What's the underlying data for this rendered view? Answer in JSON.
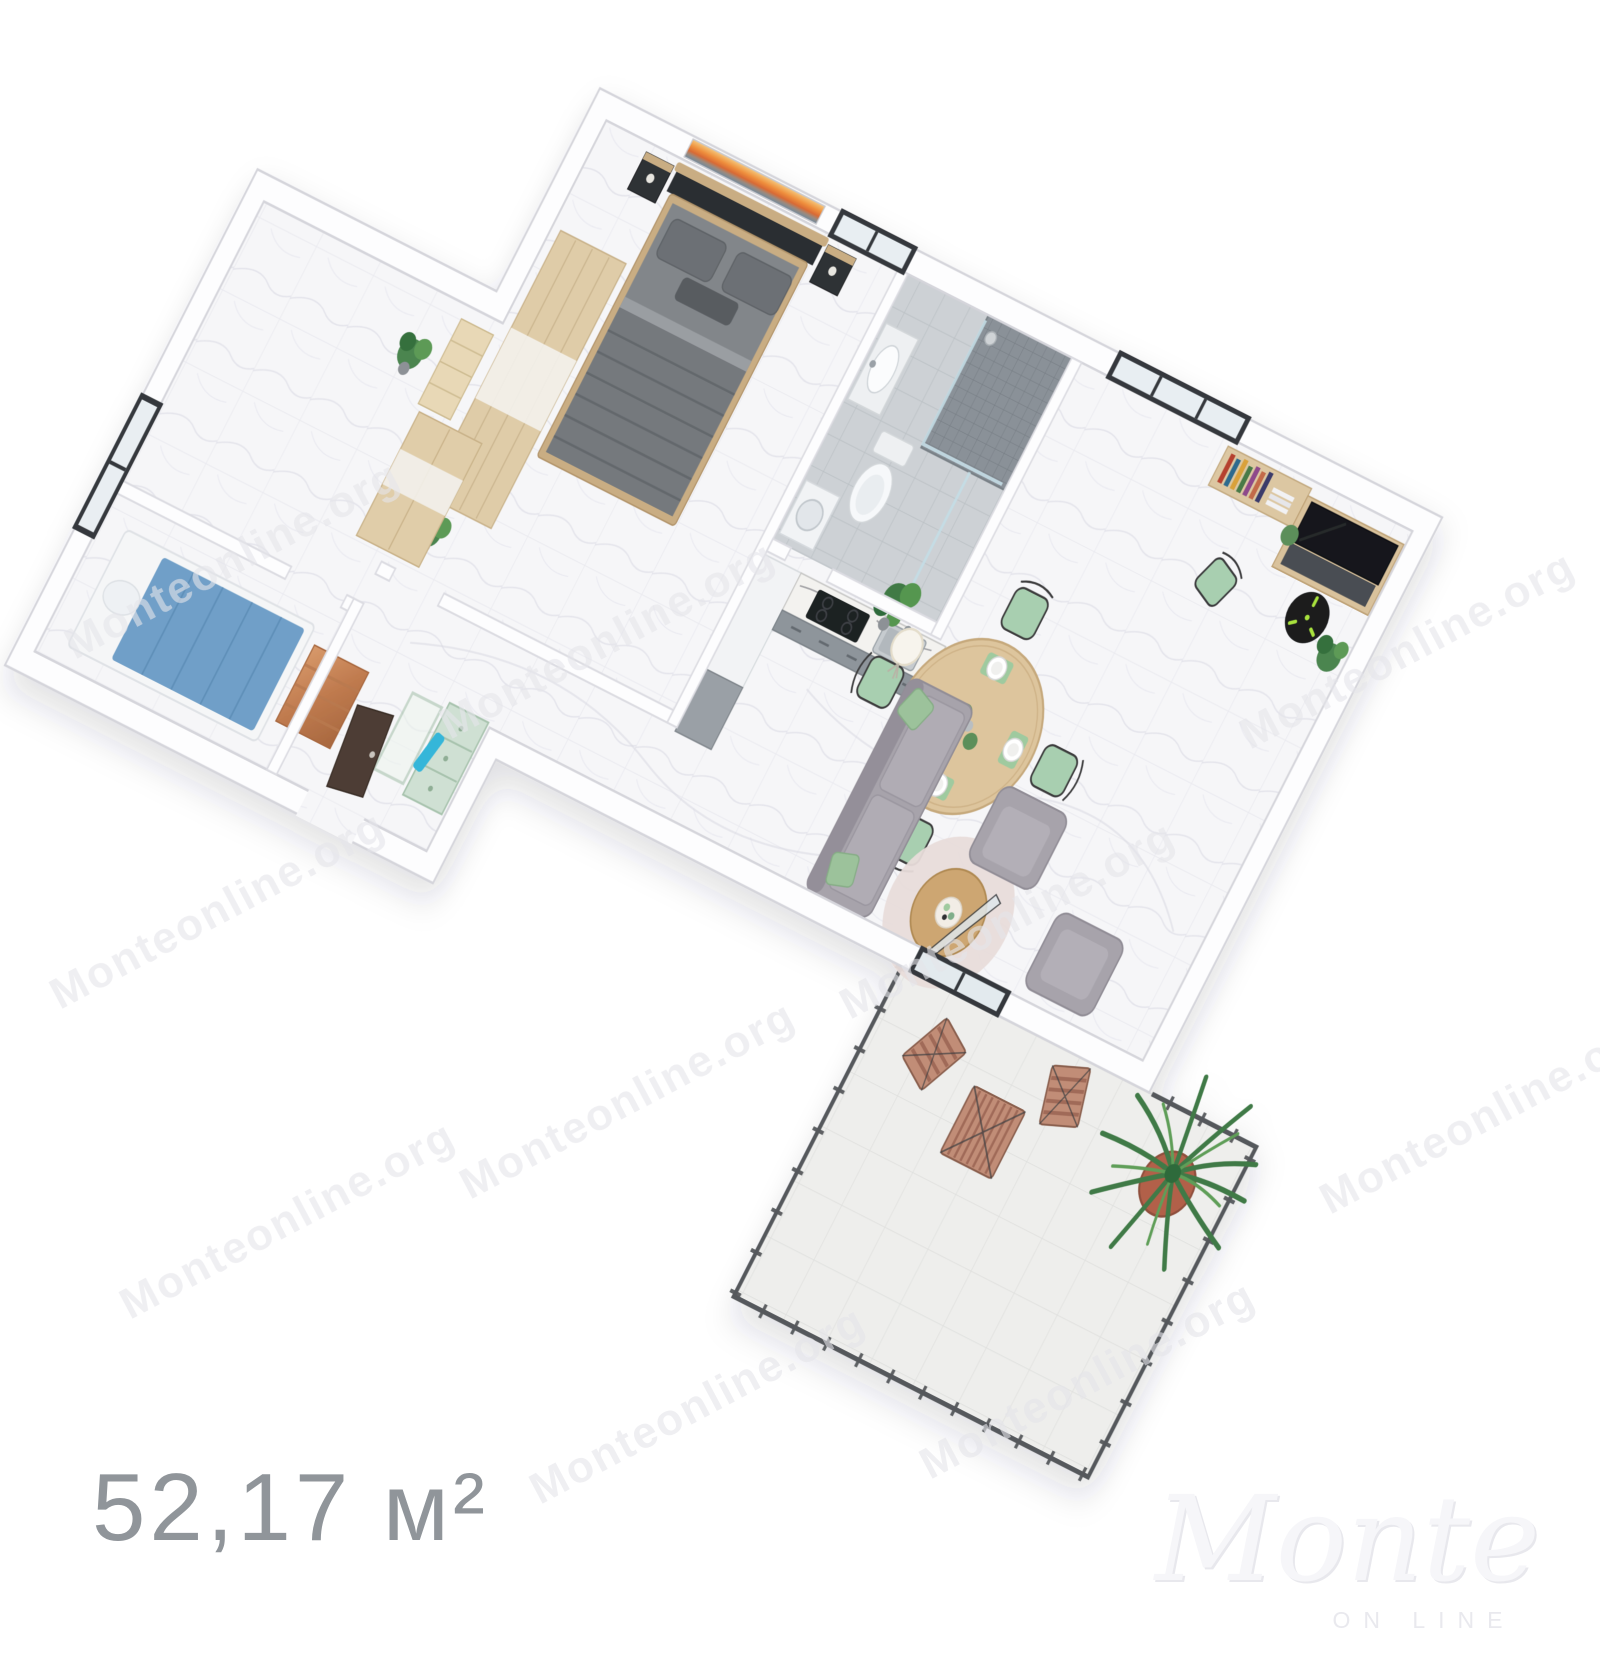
{
  "floorplan": {
    "area_label": "52,17 м²",
    "watermark": {
      "text": "Monteonline.org"
    },
    "logo": {
      "script": "Monte",
      "subtitle": "ON LINE"
    },
    "palette": {
      "background": "#ffffff",
      "wall_white": "#fdfdfe",
      "wall_outline": "#d5d5db",
      "floor_marble": "#f6f6f8",
      "bath_tile": "#cdd1d5",
      "shower_mosaic": "#8a9198",
      "bed_gray": "#82868a",
      "headboard_black": "#2b2d30",
      "wood_light": "#dfcca8",
      "kids_bed_blue": "#6f9fc8",
      "mint_green": "#cfe0d3",
      "sofa_gray": "#a7a3ab",
      "accent_green": "#9fca9f",
      "table_wood": "#ddc59d",
      "balcony_wood": "#c18d77",
      "terracotta_pot": "#b2614a",
      "plant_green": "#3f7a46",
      "clock_hands": "#a9e23e",
      "window_frame": "#35393d",
      "area_text_gray": "#90959a"
    }
  }
}
